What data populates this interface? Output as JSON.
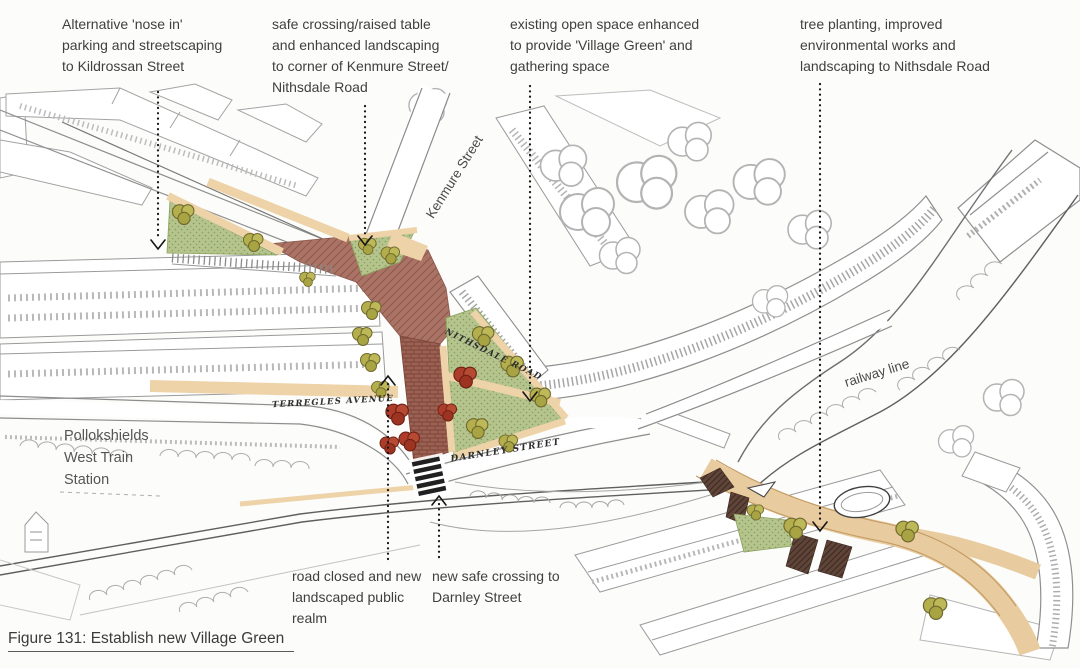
{
  "figure": {
    "caption": "Figure 131: Establish new Village Green"
  },
  "annotations": {
    "top": [
      {
        "id": "nose-in-parking",
        "lines": [
          "Alternative 'nose in'",
          "parking and streetscaping",
          "to Kildrossan Street"
        ]
      },
      {
        "id": "safe-crossing-kenmure",
        "lines": [
          "safe crossing/raised table",
          "and enhanced landscaping",
          "to corner of Kenmure Street/",
          "Nithsdale Road"
        ]
      },
      {
        "id": "village-green",
        "lines": [
          "existing open space enhanced",
          "to provide 'Village Green' and",
          "gathering space"
        ]
      },
      {
        "id": "tree-planting",
        "lines": [
          "tree planting, improved",
          "environmental works and",
          "landscaping to Nithsdale Road"
        ]
      }
    ],
    "bottom": [
      {
        "id": "road-closed",
        "lines": [
          "road closed and new",
          "landscaped public",
          "realm"
        ]
      },
      {
        "id": "new-safe-crossing",
        "lines": [
          "new safe crossing to",
          "Darnley Street"
        ]
      }
    ]
  },
  "map_labels": {
    "kenmure_street": "Kenmure Street",
    "railway_line": "railway line",
    "terregles_avenue": "TERREGLES AVENUE",
    "nithsdale_road": "NITHSDALE ROAD",
    "darnley_street": "DARNLEY STREET",
    "station_lines": [
      "Pollokshields",
      "West Train",
      "Station"
    ]
  },
  "colors": {
    "raised_table_road": "#a97062",
    "closed_road_brick": "#9c6152",
    "green_space": "#b5c38d",
    "paving_tan": "#eed3a9",
    "tree_olive": "#b4af4c",
    "tree_red": "#ad3d2a",
    "dark_crossing": "#5f4539"
  }
}
